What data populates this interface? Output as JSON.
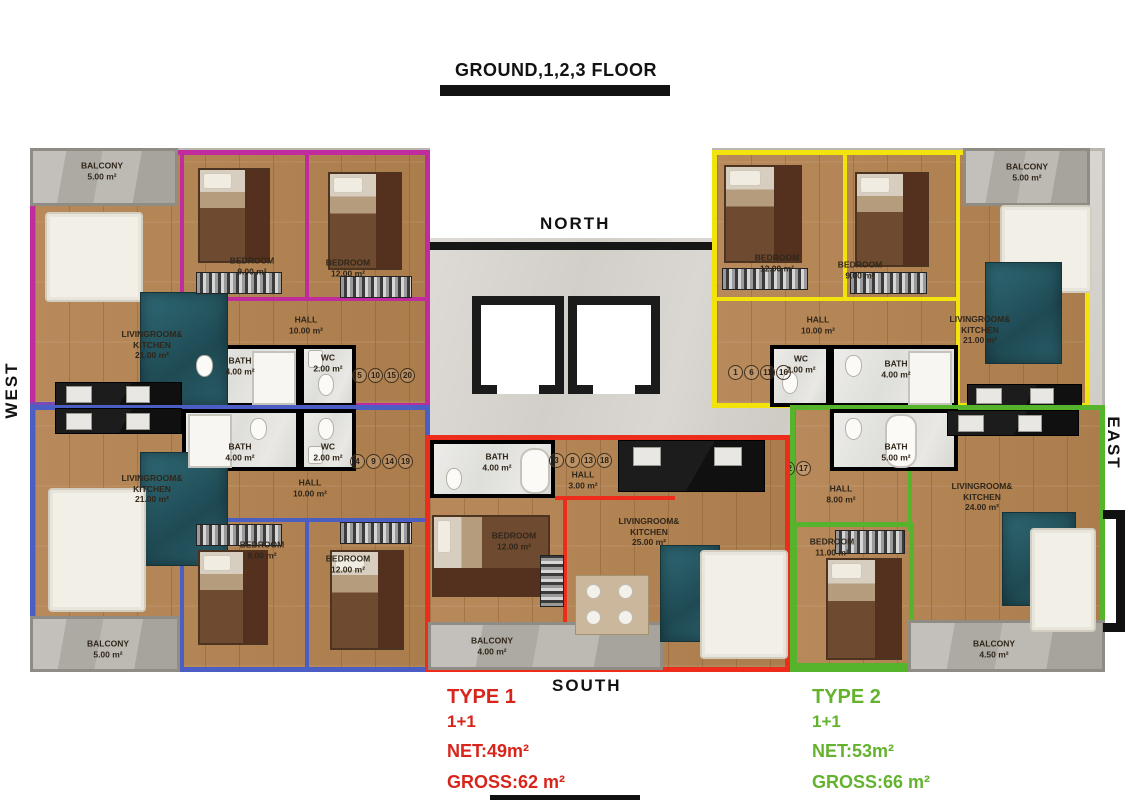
{
  "title": {
    "text": "GROUND,1,2,3 FLOOR"
  },
  "compass": {
    "north": "NORTH",
    "south": "SOUTH",
    "east": "EAST",
    "west": "WEST"
  },
  "legend": {
    "type1": {
      "name": "TYPE 1",
      "plan": "1+1",
      "net": "NET:49m²",
      "gross": "GROSS:62 m²"
    },
    "type2": {
      "name": "TYPE 2",
      "plan": "1+1",
      "net": "NET:53m²",
      "gross": "GROSS:66 m²"
    }
  },
  "colors": {
    "magenta": "#c02b9e",
    "purple": "#7b4bb5",
    "blue": "#4a5ec4",
    "yellow": "#f2e30c",
    "green": "#56b32c",
    "red": "#ee2c1c",
    "type1_text": "#d8251c",
    "type2_text": "#63b32e",
    "wall": "#161616"
  },
  "units": {
    "magenta": {
      "numbers": [
        "5",
        "10",
        "15",
        "20"
      ],
      "rooms": {
        "balcony": {
          "name": "BALCONY",
          "area": "5.00 m²"
        },
        "living": {
          "name": "LIVINGROOM& KITCHEN",
          "area": "21.00 m²"
        },
        "bedroom1": {
          "name": "BEDROOM",
          "area": "9.00 m²"
        },
        "bedroom2": {
          "name": "BEDROOM",
          "area": "12.00 m²"
        },
        "hall": {
          "name": "HALL",
          "area": "10.00 m²"
        },
        "bath": {
          "name": "BATH",
          "area": "4.00 m²"
        },
        "wc": {
          "name": "WC",
          "area": "2.00 m²"
        }
      }
    },
    "blue": {
      "numbers": [
        "4",
        "9",
        "14",
        "19"
      ],
      "rooms": {
        "balcony": {
          "name": "BALCONY",
          "area": "5.00 m²"
        },
        "living": {
          "name": "LIVINGROOM& KITCHEN",
          "area": "21.00 m²"
        },
        "bedroom1": {
          "name": "BEDROOM",
          "area": "9.00 m²"
        },
        "bedroom2": {
          "name": "BEDROOM",
          "area": "12.00 m²"
        },
        "hall": {
          "name": "HALL",
          "area": "10.00 m²"
        },
        "bath": {
          "name": "BATH",
          "area": "4.00 m²"
        },
        "wc": {
          "name": "WC",
          "area": "2.00 m²"
        }
      }
    },
    "yellow": {
      "numbers": [
        "1",
        "6",
        "11",
        "16"
      ],
      "rooms": {
        "balcony": {
          "name": "BALCONY",
          "area": "5.00 m²"
        },
        "living": {
          "name": "LIVINGROOM& KITCHEN",
          "area": "21.00 m²"
        },
        "bedroom1": {
          "name": "BEDROOM",
          "area": "12.00 m²"
        },
        "bedroom2": {
          "name": "BEDROOM",
          "area": "9.00 m²"
        },
        "hall": {
          "name": "HALL",
          "area": "10.00 m²"
        },
        "bath": {
          "name": "BATH",
          "area": "4.00 m²"
        },
        "wc": {
          "name": "WC",
          "area": "2.00 m²"
        }
      }
    },
    "green": {
      "numbers": [
        "2",
        "7",
        "12",
        "17"
      ],
      "rooms": {
        "balcony": {
          "name": "BALCONY",
          "area": "4.50 m²"
        },
        "living": {
          "name": "LIVINGROOM& KITCHEN",
          "area": "24.00 m²"
        },
        "bedroom": {
          "name": "BEDROOM",
          "area": "11.00 m²"
        },
        "hall": {
          "name": "HALL",
          "area": "8.00 m²"
        },
        "bath": {
          "name": "BATH",
          "area": "5.00 m²"
        }
      }
    },
    "red": {
      "numbers": [
        "3",
        "8",
        "13",
        "18"
      ],
      "rooms": {
        "balcony": {
          "name": "BALCONY",
          "area": "4.00 m²"
        },
        "living": {
          "name": "LIVINGROOM& KITCHEN",
          "area": "25.00 m²"
        },
        "bedroom": {
          "name": "BEDROOM",
          "area": "12.00 m²"
        },
        "hall": {
          "name": "HALL",
          "area": "3.00 m²"
        },
        "bath": {
          "name": "BATH",
          "area": "4.00 m²"
        }
      }
    }
  }
}
